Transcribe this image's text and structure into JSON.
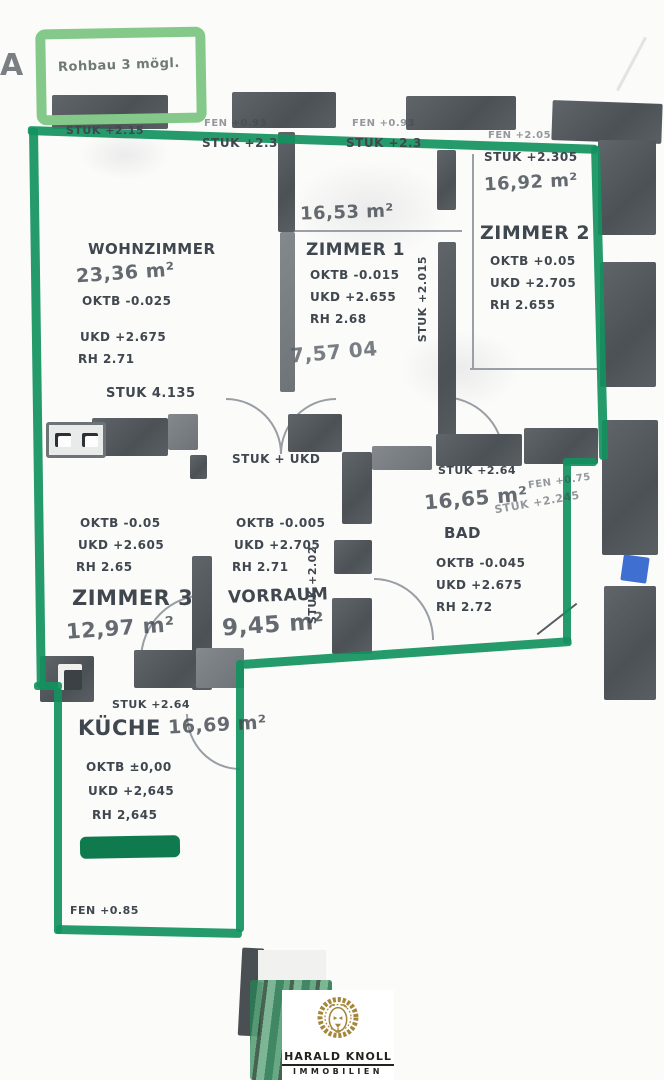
{
  "colors": {
    "outline_green": "#12915e",
    "note_box_green": "#85c98a",
    "wall_gray": "#54595e",
    "pencil_gray": "#40474f",
    "logo_gold": "#a5873b",
    "blue_mark": "#3f6fd0"
  },
  "corner_letter": "A",
  "top_note": "Rohbau 3 mögl.",
  "rooms": {
    "wohnzimmer": {
      "name": "WOHNZIMMER",
      "area": "23,36 m²",
      "l1": "OKTB -0.025",
      "l2": "UKD +2.675",
      "l3": "RH 2.71"
    },
    "zimmer1": {
      "name": "ZIMMER 1",
      "area": "16,53 m²",
      "l1": "OKTB -0.015",
      "l2": "UKD +2.655",
      "l3": "RH 2.68",
      "note": "7,57 04"
    },
    "zimmer2": {
      "name": "ZIMMER 2",
      "area": "16,92 m²",
      "l1": "OKTB +0.05",
      "l2": "UKD +2.705",
      "l3": "RH 2.655",
      "fen": "FEN +2.05",
      "stuk": "STUK +2.305"
    },
    "zimmer3": {
      "name": "ZIMMER 3",
      "area": "12,97 m²",
      "l1": "OKTB -0.05",
      "l2": "UKD +2.605",
      "l3": "RH 2.65"
    },
    "vorraum": {
      "name": "VORRAUM",
      "area": "9,45 m²",
      "l1": "OKTB -0.005",
      "l2": "UKD +2.705",
      "l3": "RH 2.71"
    },
    "bad": {
      "name": "BAD",
      "area": "16,65 m²",
      "l1": "OKTB -0.045",
      "l2": "UKD +2.675",
      "l3": "RH 2.72",
      "stuk": "STUK +2.64",
      "fen": "FEN +0.75",
      "stuk2": "STUK +2.245"
    },
    "kueche": {
      "name": "KÜCHE",
      "area": "16,69 m²",
      "l1": "OKTB ±0,00",
      "l2": "UKD +2,645",
      "l3": "RH 2,645",
      "stuk": "STUK +2.64",
      "fen": "FEN +0.85"
    }
  },
  "annotations": {
    "stuk_top_left": "STUK +2.15",
    "fen_top_1": "FEN +0.93",
    "stuk_top_1": "STUK +2.3",
    "fen_top_2": "FEN +0.93",
    "stuk_top_2": "STUK +2.3",
    "stuk_mid": "STUK 4.135",
    "stuk_ukd": "STUK + UKD",
    "stuk_vertical_1": "STUK +2.015",
    "stuk_vertical_2": "STUK +2.02"
  },
  "logo": {
    "name": "HARALD KNOLL",
    "subtitle": "IMMOBILIEN"
  }
}
